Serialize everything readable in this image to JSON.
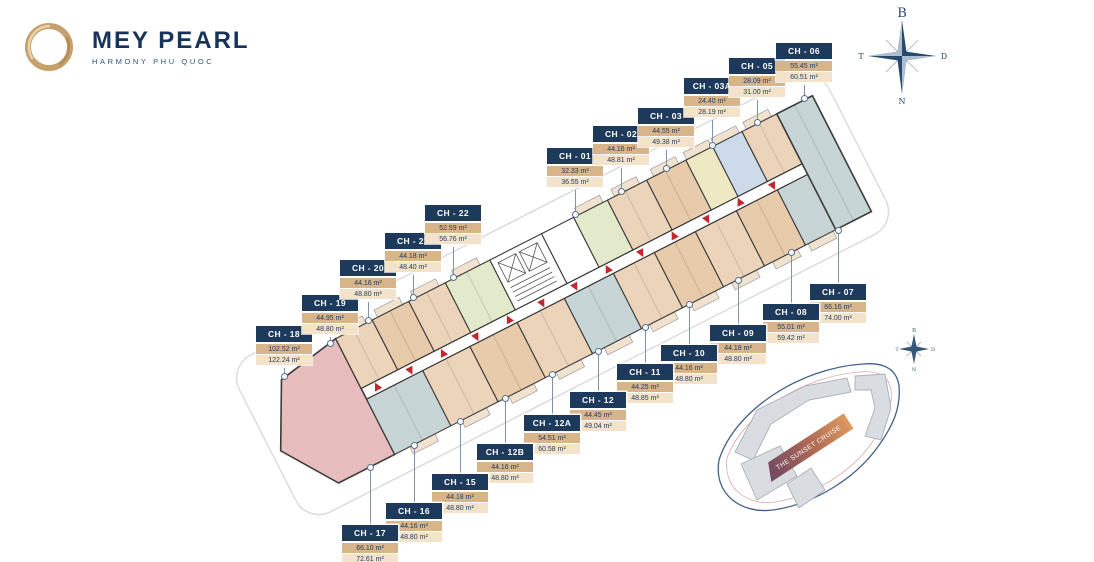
{
  "brand": {
    "title": "MEY PEARL",
    "subtitle": "HARMONY PHU QUOC"
  },
  "compass": {
    "north": "B",
    "west": "T",
    "east": "D",
    "south": "N"
  },
  "units": [
    {
      "id": "CH - 01",
      "area1": "32.33 m²",
      "area2": "36.55 m²"
    },
    {
      "id": "CH - 02",
      "area1": "44.16 m²",
      "area2": "48.81 m²"
    },
    {
      "id": "CH - 03",
      "area1": "44.55 m²",
      "area2": "49.38 m²"
    },
    {
      "id": "CH - 03A",
      "area1": "24.40 m²",
      "area2": "28.19 m²"
    },
    {
      "id": "CH - 05",
      "area1": "28.09 m²",
      "area2": "31.00 m²"
    },
    {
      "id": "CH - 06",
      "area1": "55.45 m²",
      "area2": "60.51 m²"
    },
    {
      "id": "CH - 07",
      "area1": "66.16 m²",
      "area2": "74.00 m²"
    },
    {
      "id": "CH - 08",
      "area1": "55.01 m²",
      "area2": "59.42 m²"
    },
    {
      "id": "CH - 09",
      "area1": "44.18 m²",
      "area2": "48.80 m²"
    },
    {
      "id": "CH - 10",
      "area1": "44.16 m²",
      "area2": "48.80 m²"
    },
    {
      "id": "CH - 11",
      "area1": "44.25 m²",
      "area2": "48.85 m²"
    },
    {
      "id": "CH - 12",
      "area1": "44.45 m²",
      "area2": "49.04 m²"
    },
    {
      "id": "CH - 12A",
      "area1": "54.51 m²",
      "area2": "60.58 m²"
    },
    {
      "id": "CH - 12B",
      "area1": "44.16 m²",
      "area2": "48.80 m²"
    },
    {
      "id": "CH - 15",
      "area1": "44.18 m²",
      "area2": "48.80 m²"
    },
    {
      "id": "CH - 16",
      "area1": "44.16 m²",
      "area2": "48.80 m²"
    },
    {
      "id": "CH - 17",
      "area1": "66.10 m²",
      "area2": "72.61 m²"
    },
    {
      "id": "CH - 18",
      "area1": "102.52 m²",
      "area2": "122.24 m²"
    },
    {
      "id": "CH - 19",
      "area1": "44.95 m²",
      "area2": "48.80 m²"
    },
    {
      "id": "CH - 20",
      "area1": "44.16 m²",
      "area2": "48.80 m²"
    },
    {
      "id": "CH - 21",
      "area1": "44.18 m²",
      "area2": "48.40 m²"
    },
    {
      "id": "CH - 22",
      "area1": "52.59 m²",
      "area2": "56.76 m²"
    }
  ],
  "minimap": {
    "ribbon": "THE SUNSET CRUISE"
  },
  "palette": {
    "navy": "#1d3a5c",
    "gold": "#c6a06b",
    "label_tan": "#d8b48a",
    "label_cream": "#f2e3ca",
    "unit_tan": "#ebd4ba",
    "unit_pink": "#e8bdbd",
    "unit_green": "#e3eacb",
    "unit_gray": "#c8d5d6",
    "unit_yellow": "#efe9c3",
    "unit_blue": "#ccdaea",
    "arrow_red": "#c1272d"
  }
}
